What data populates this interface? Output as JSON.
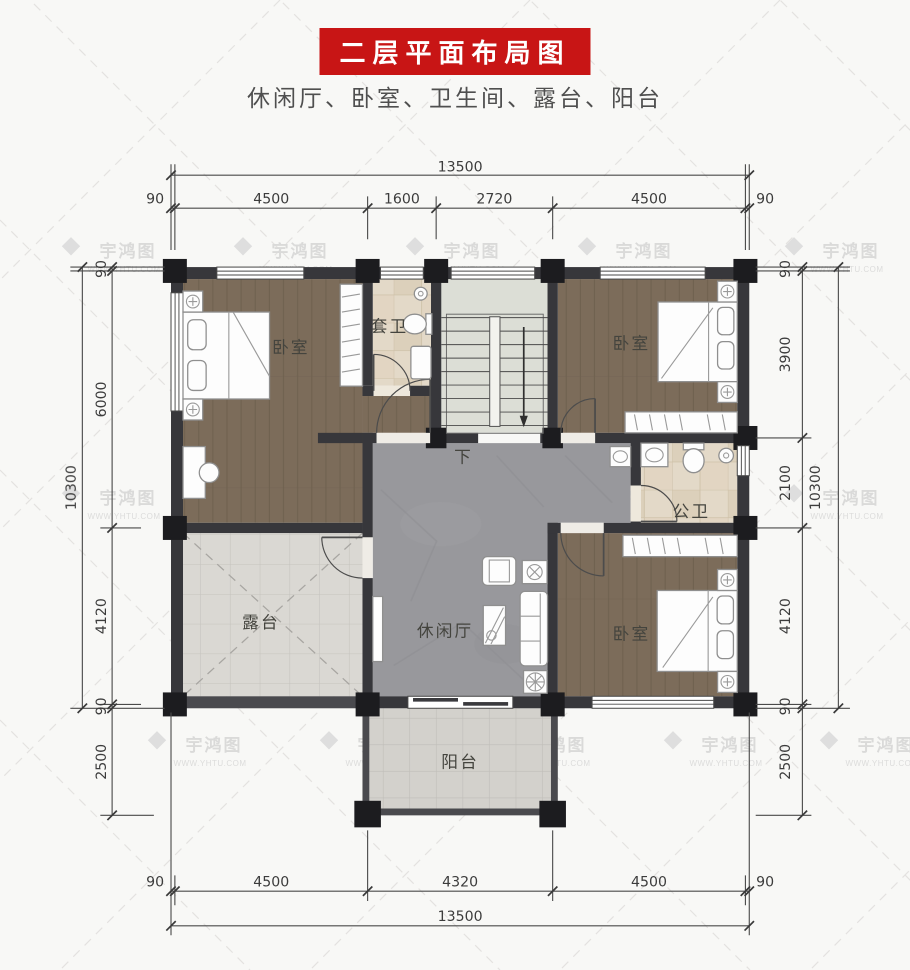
{
  "title": {
    "text": "二层平面布局图",
    "banner_color": "#c81515"
  },
  "subtitle": {
    "text": "休闲厅、卧室、卫生间、露台、阳台"
  },
  "watermark": {
    "brand": "宇鸿图",
    "url": "WWW.YHTU.COM"
  },
  "rooms": {
    "bedroom_top_left": "卧室",
    "bedroom_top_right": "卧室",
    "bedroom_bottom_right": "卧室",
    "ensuite_bathroom": "套卫",
    "shared_bathroom": "公卫",
    "leisure_hall": "休闲厅",
    "terrace": "露台",
    "balcony": "阳台",
    "stair_down": "下"
  },
  "dimensions": {
    "top": {
      "total": "13500",
      "segments": [
        "90",
        "4500",
        "1600",
        "2720",
        "4500",
        "90"
      ]
    },
    "bottom": {
      "total": "13500",
      "segments": [
        "90",
        "4500",
        "4320",
        "4500",
        "90"
      ]
    },
    "left": {
      "total": "10300",
      "segments": [
        "90",
        "6000",
        "4120",
        "90",
        "2500"
      ]
    },
    "right": {
      "total": "10300",
      "segments": [
        "90",
        "3900",
        "2100",
        "4120",
        "90",
        "2500"
      ]
    }
  },
  "colors": {
    "wall": "#37373b",
    "wood_floor": "#7c6c5a",
    "marble_floor": "#98989c",
    "terrace_tile": "#dad8d3",
    "bath_tile": "#e3d9c8",
    "stair_floor": "#dcded6",
    "banner_red": "#c81515"
  }
}
